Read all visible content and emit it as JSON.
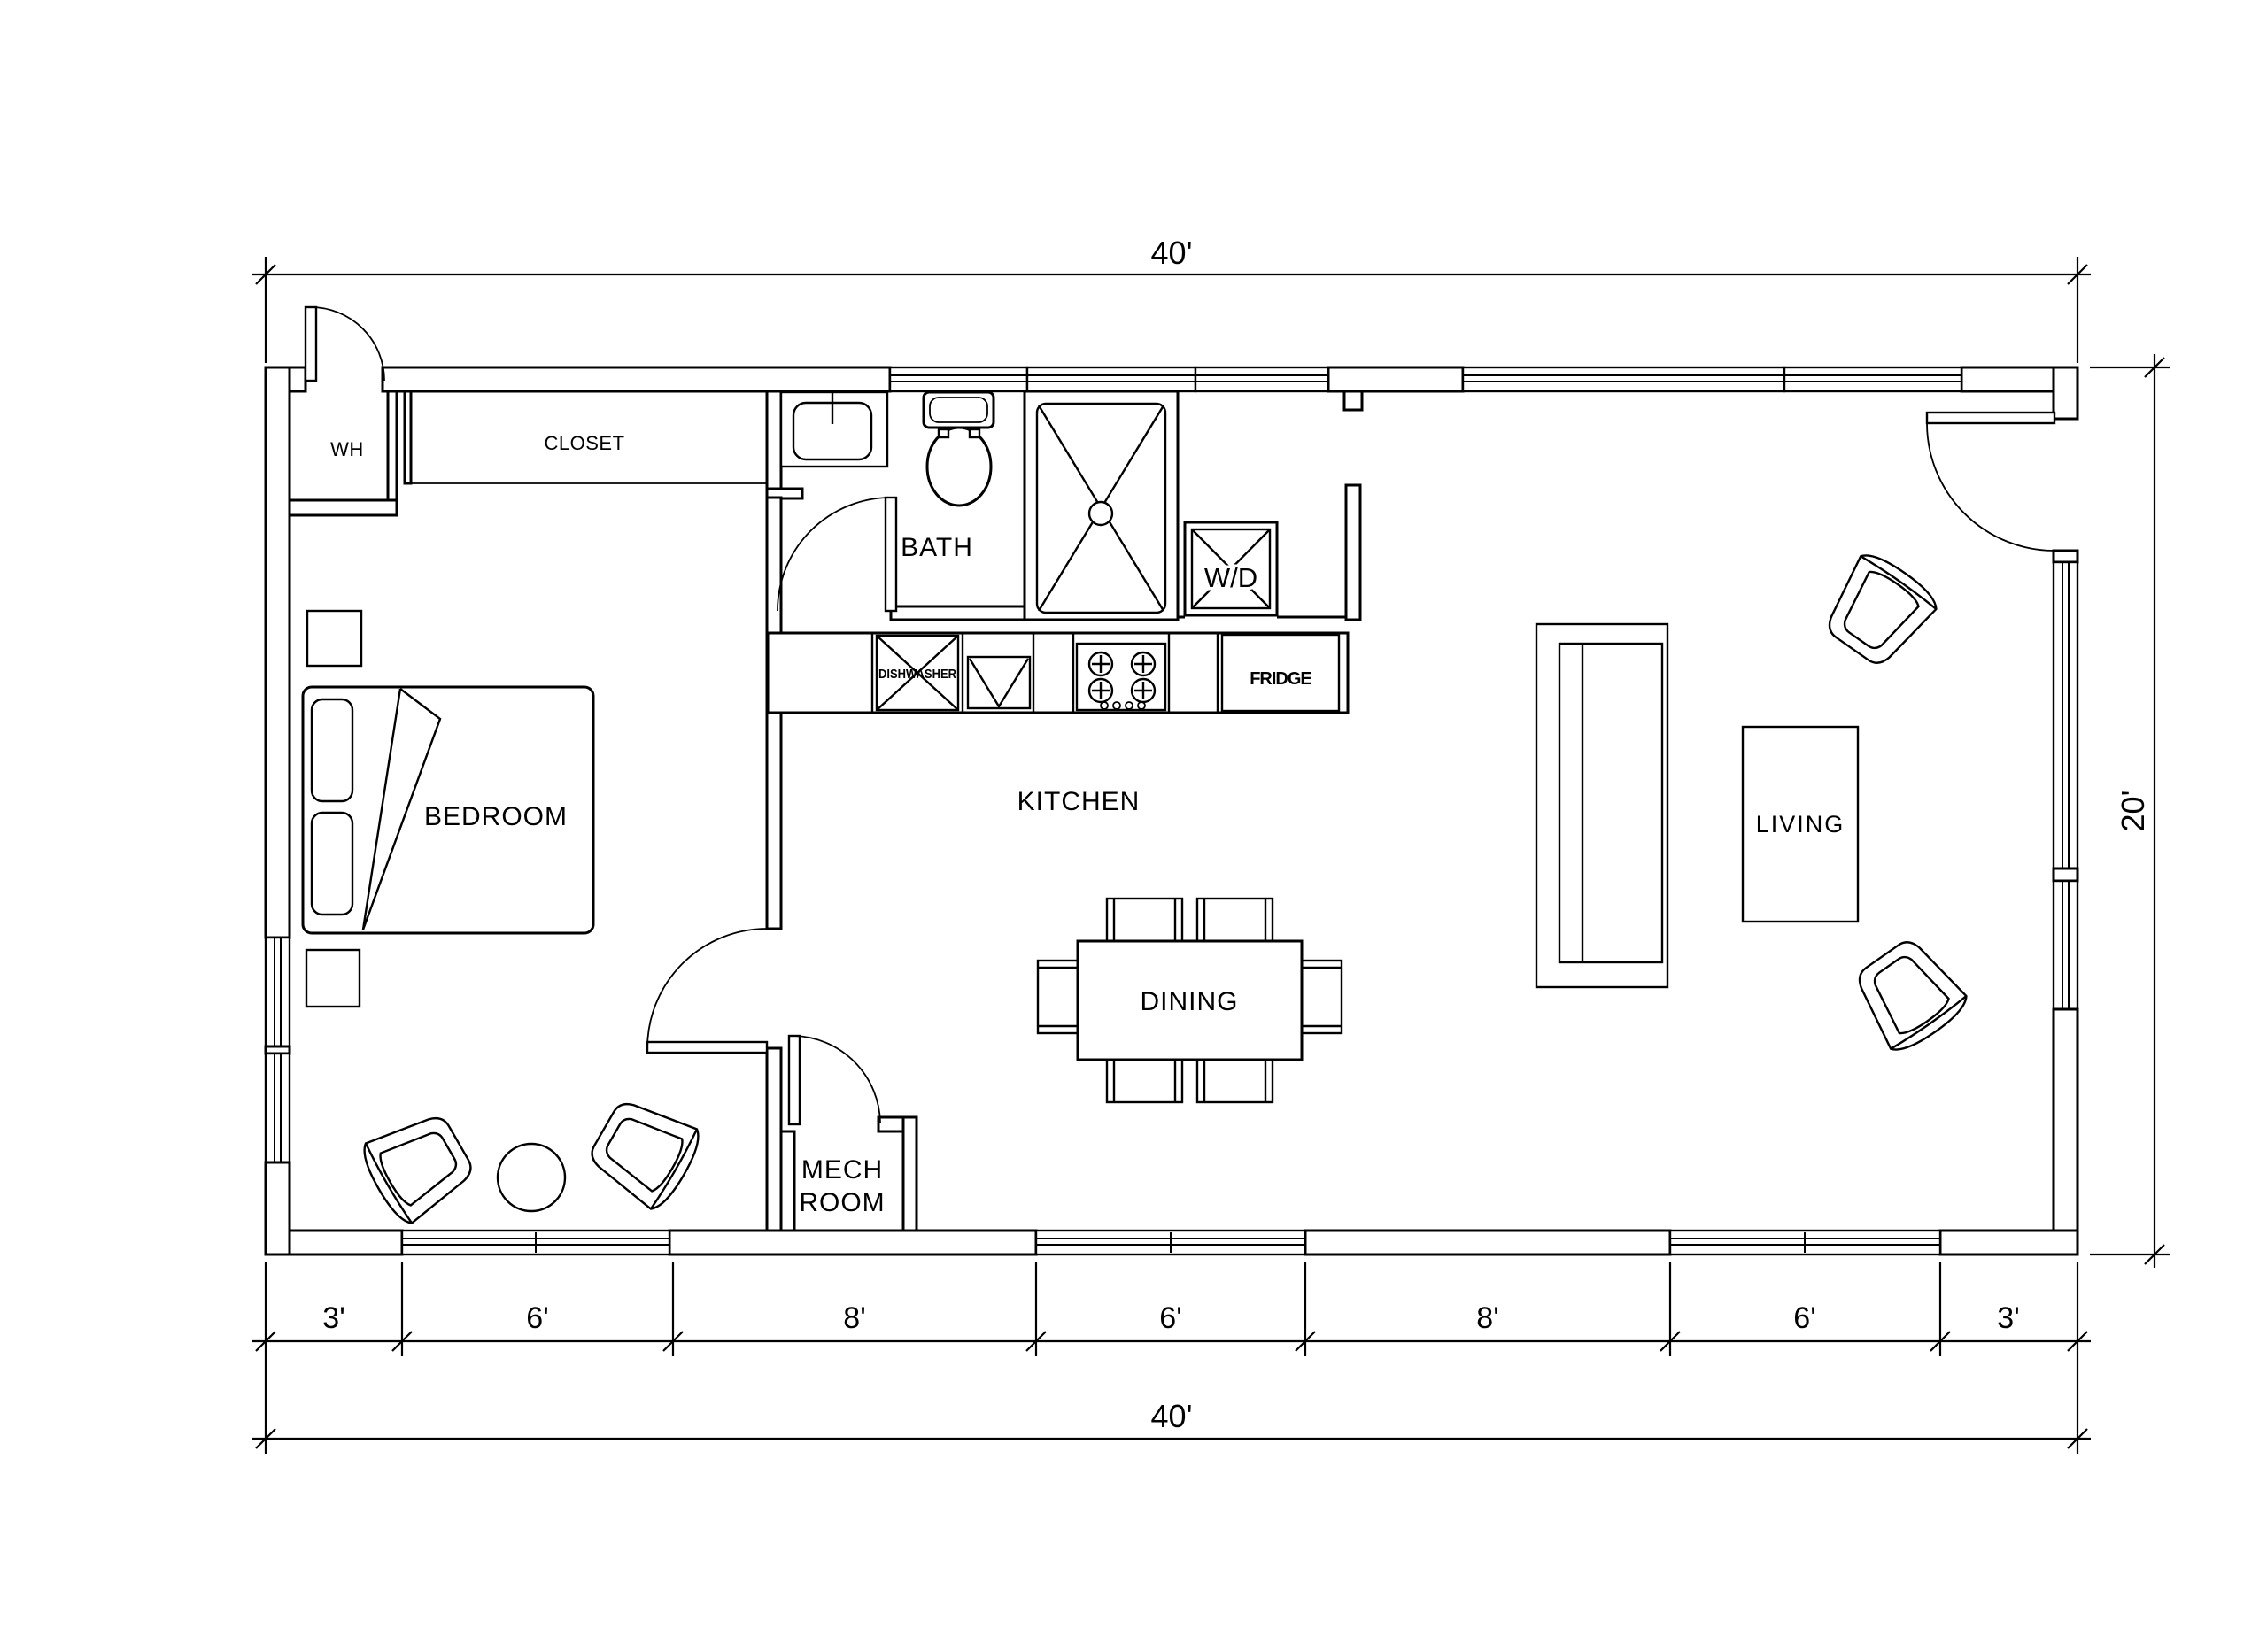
{
  "drawing": {
    "type": "architectural-floor-plan",
    "colors": {
      "ink": "#000000",
      "background": "#ffffff"
    },
    "rooms": {
      "bedroom": "BEDROOM",
      "bath": "BATH",
      "kitchen": "KITCHEN",
      "dining": "DINING",
      "living": "LIVING",
      "mech_line1": "MECH",
      "mech_line2": "ROOM",
      "closet": "CLOSET",
      "water_heater": "WH"
    },
    "appliances": {
      "washer_dryer": "W/D",
      "fridge": "FRIDGE",
      "dishwasher": "DISHWASHER"
    },
    "dimensions": {
      "overall_width_top": "40'",
      "overall_width_bottom": "40'",
      "overall_height_right": "20'",
      "bottom_segments": [
        "3'",
        "6'",
        "8'",
        "6'",
        "8'",
        "6'",
        "3'"
      ]
    }
  }
}
